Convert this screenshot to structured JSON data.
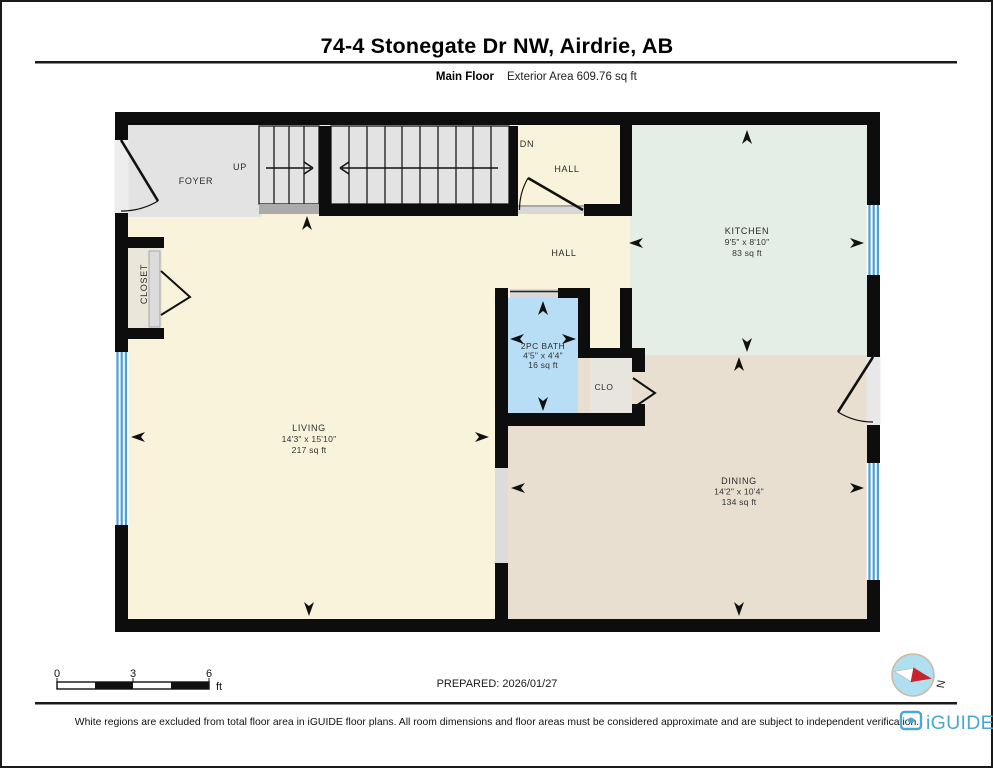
{
  "header": {
    "title": "74-4 Stonegate Dr NW, Airdrie, AB",
    "floor_label": "Main Floor",
    "area_label": "Exterior Area 609.76 sq ft"
  },
  "plan": {
    "labels": {
      "foyer": "FOYER",
      "up": "UP",
      "dn": "DN",
      "hall_upper": "HALL",
      "hall_lower": "HALL",
      "closet": "CLOSET",
      "clo": "CLO"
    },
    "kitchen": {
      "name": "KITCHEN",
      "dims": "9'5\" x 8'10\"",
      "area": "83 sq ft"
    },
    "living": {
      "name": "LIVING",
      "dims": "14'3\" x 15'10\"",
      "area": "217 sq ft"
    },
    "bath": {
      "name": "2PC BATH",
      "dims": "4'5\" x 4'4\"",
      "area": "16 sq ft"
    },
    "dining": {
      "name": "DINING",
      "dims": "14'2\" x 10'4\"",
      "area": "134 sq ft"
    }
  },
  "scale_bar": {
    "ticks": [
      "0",
      "3",
      "6"
    ],
    "unit": "ft"
  },
  "prepared_label": "PREPARED: 2026/01/27",
  "compass_label": "N",
  "footer": {
    "disclaimer": "White regions are excluded from total floor area in iGUIDE floor plans. All room dimensions and floor areas must be considered approximate and are subject to independent verification.",
    "brand": "iGUIDE"
  },
  "colors": {
    "wall": "#0d0d0d",
    "base_floor": "#FAF3DB",
    "kitchen_floor": "#E4EDE6",
    "dining_floor": "#E8DFD0",
    "bath_floor": "#B8DEF6",
    "stairs_floor": "#E3E3E3",
    "window_blue": "#4C9FD7",
    "brand_blue": "#4BA8D2",
    "compass_red": "#C9242B"
  }
}
